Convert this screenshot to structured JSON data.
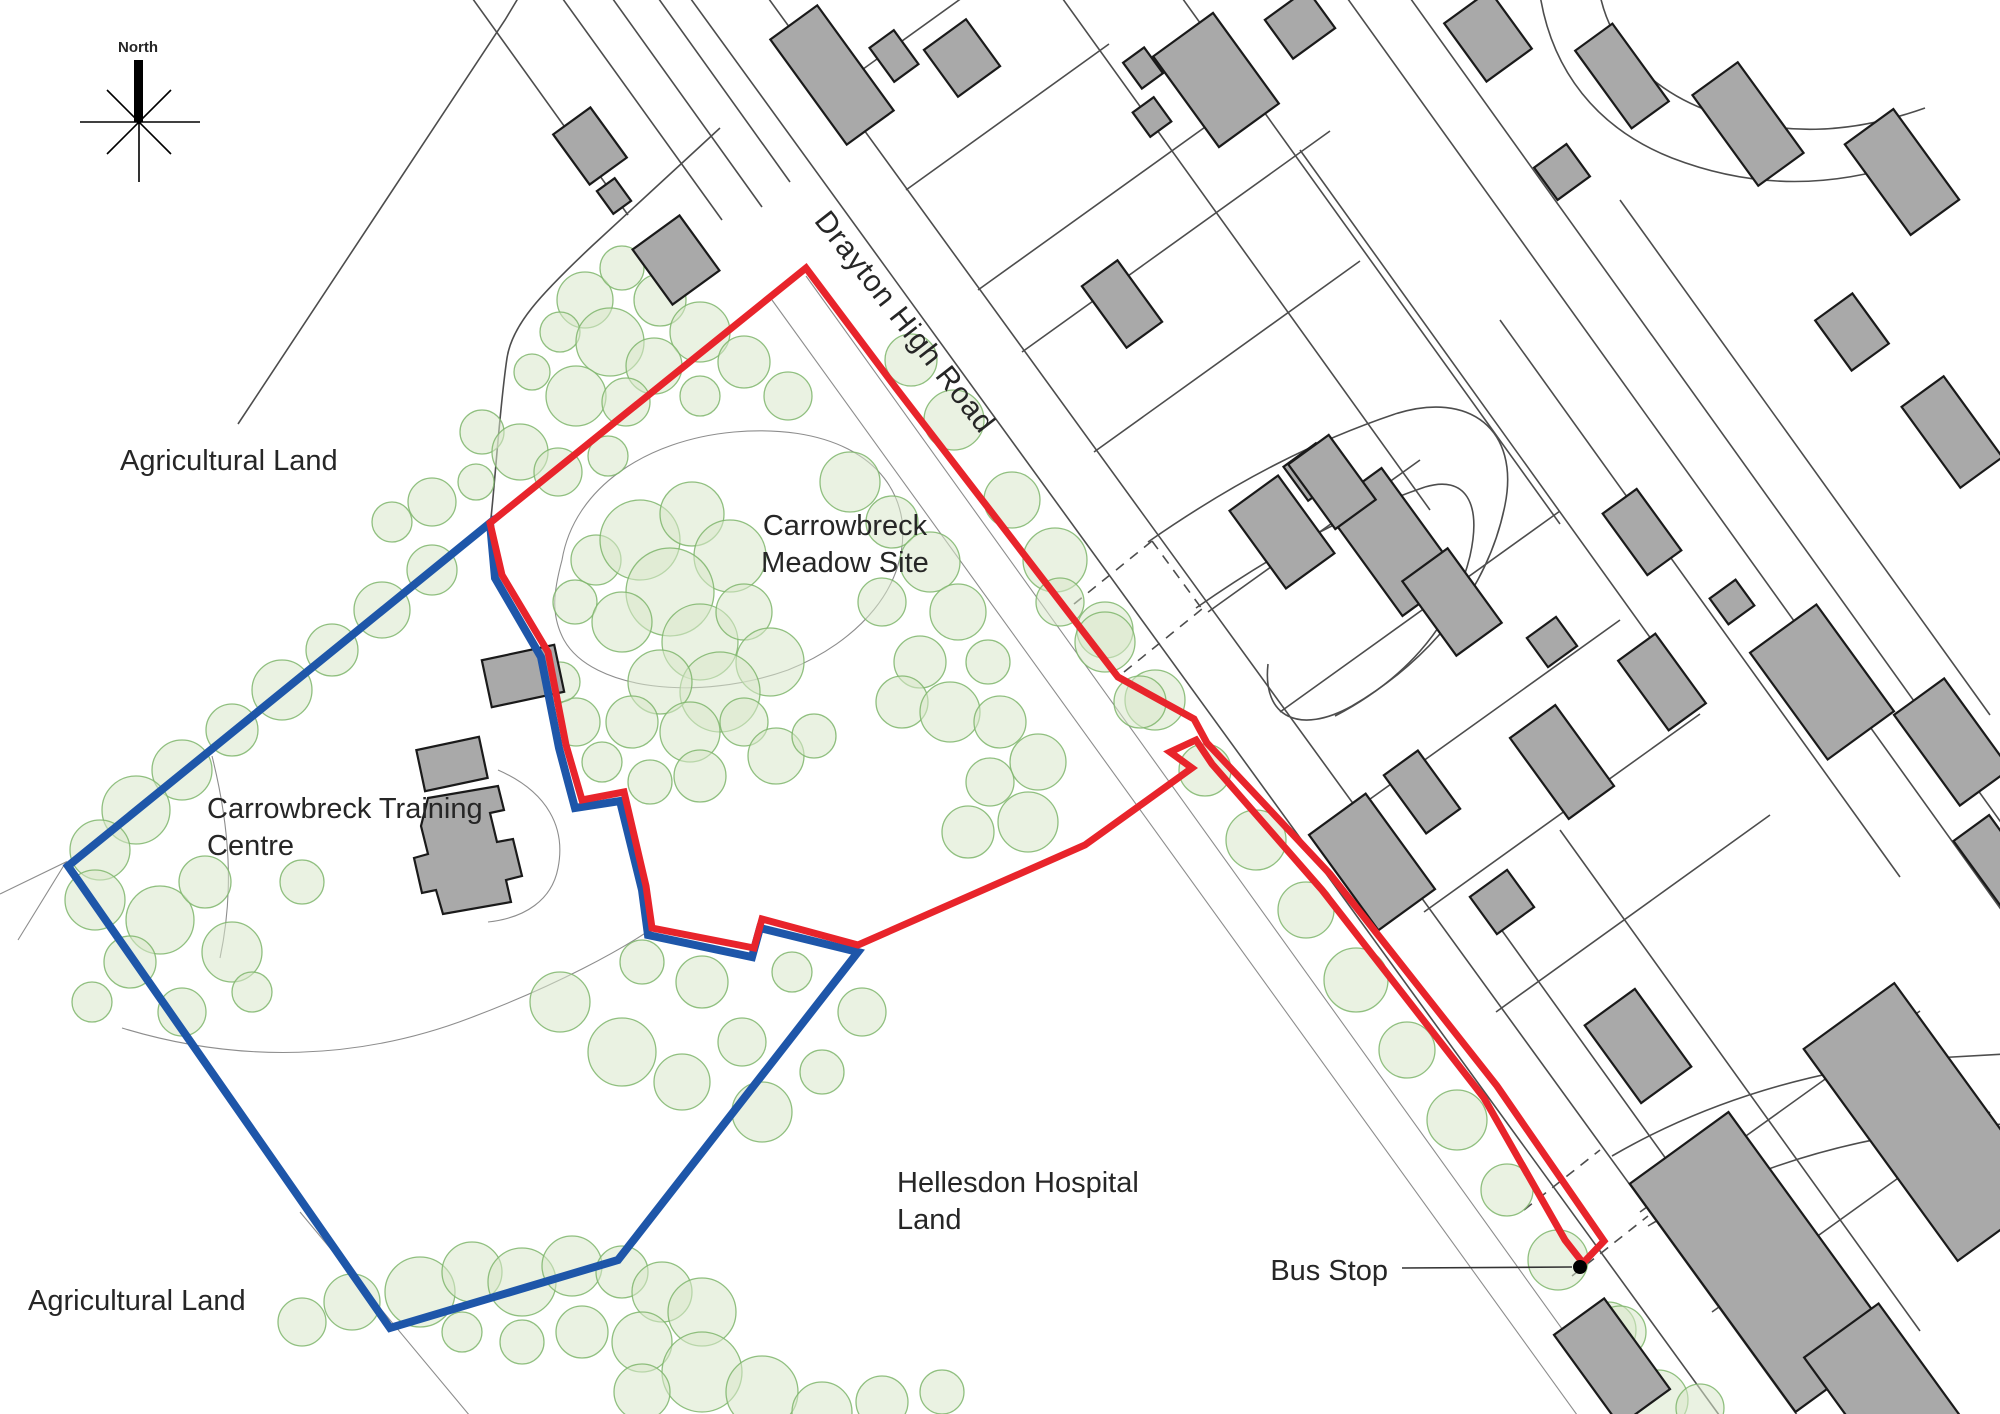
{
  "map": {
    "labels": {
      "north": "North",
      "agricultural_land_top": "Agricultural Land",
      "agricultural_land_bottom": "Agricultural Land",
      "meadow_site_line1": "Carrowbreck",
      "meadow_site_line2": "Meadow Site",
      "training_line1": "Carrowbreck Training",
      "training_line2": "Centre",
      "hospital_line1": "Hellesdon Hospital",
      "hospital_line2": "Land",
      "road_name": "Drayton High Road",
      "bus_stop": "Bus Stop"
    },
    "colors": {
      "red_boundary": "#e8242b",
      "blue_boundary": "#1e56a9",
      "tree_fill": "#d8e8cb",
      "tree_stroke": "#7eb56b",
      "building_fill": "#a9a9a9",
      "building_stroke": "#1a1a1a",
      "parcel_line": "#4d4d4d",
      "label_text": "#262626"
    }
  }
}
